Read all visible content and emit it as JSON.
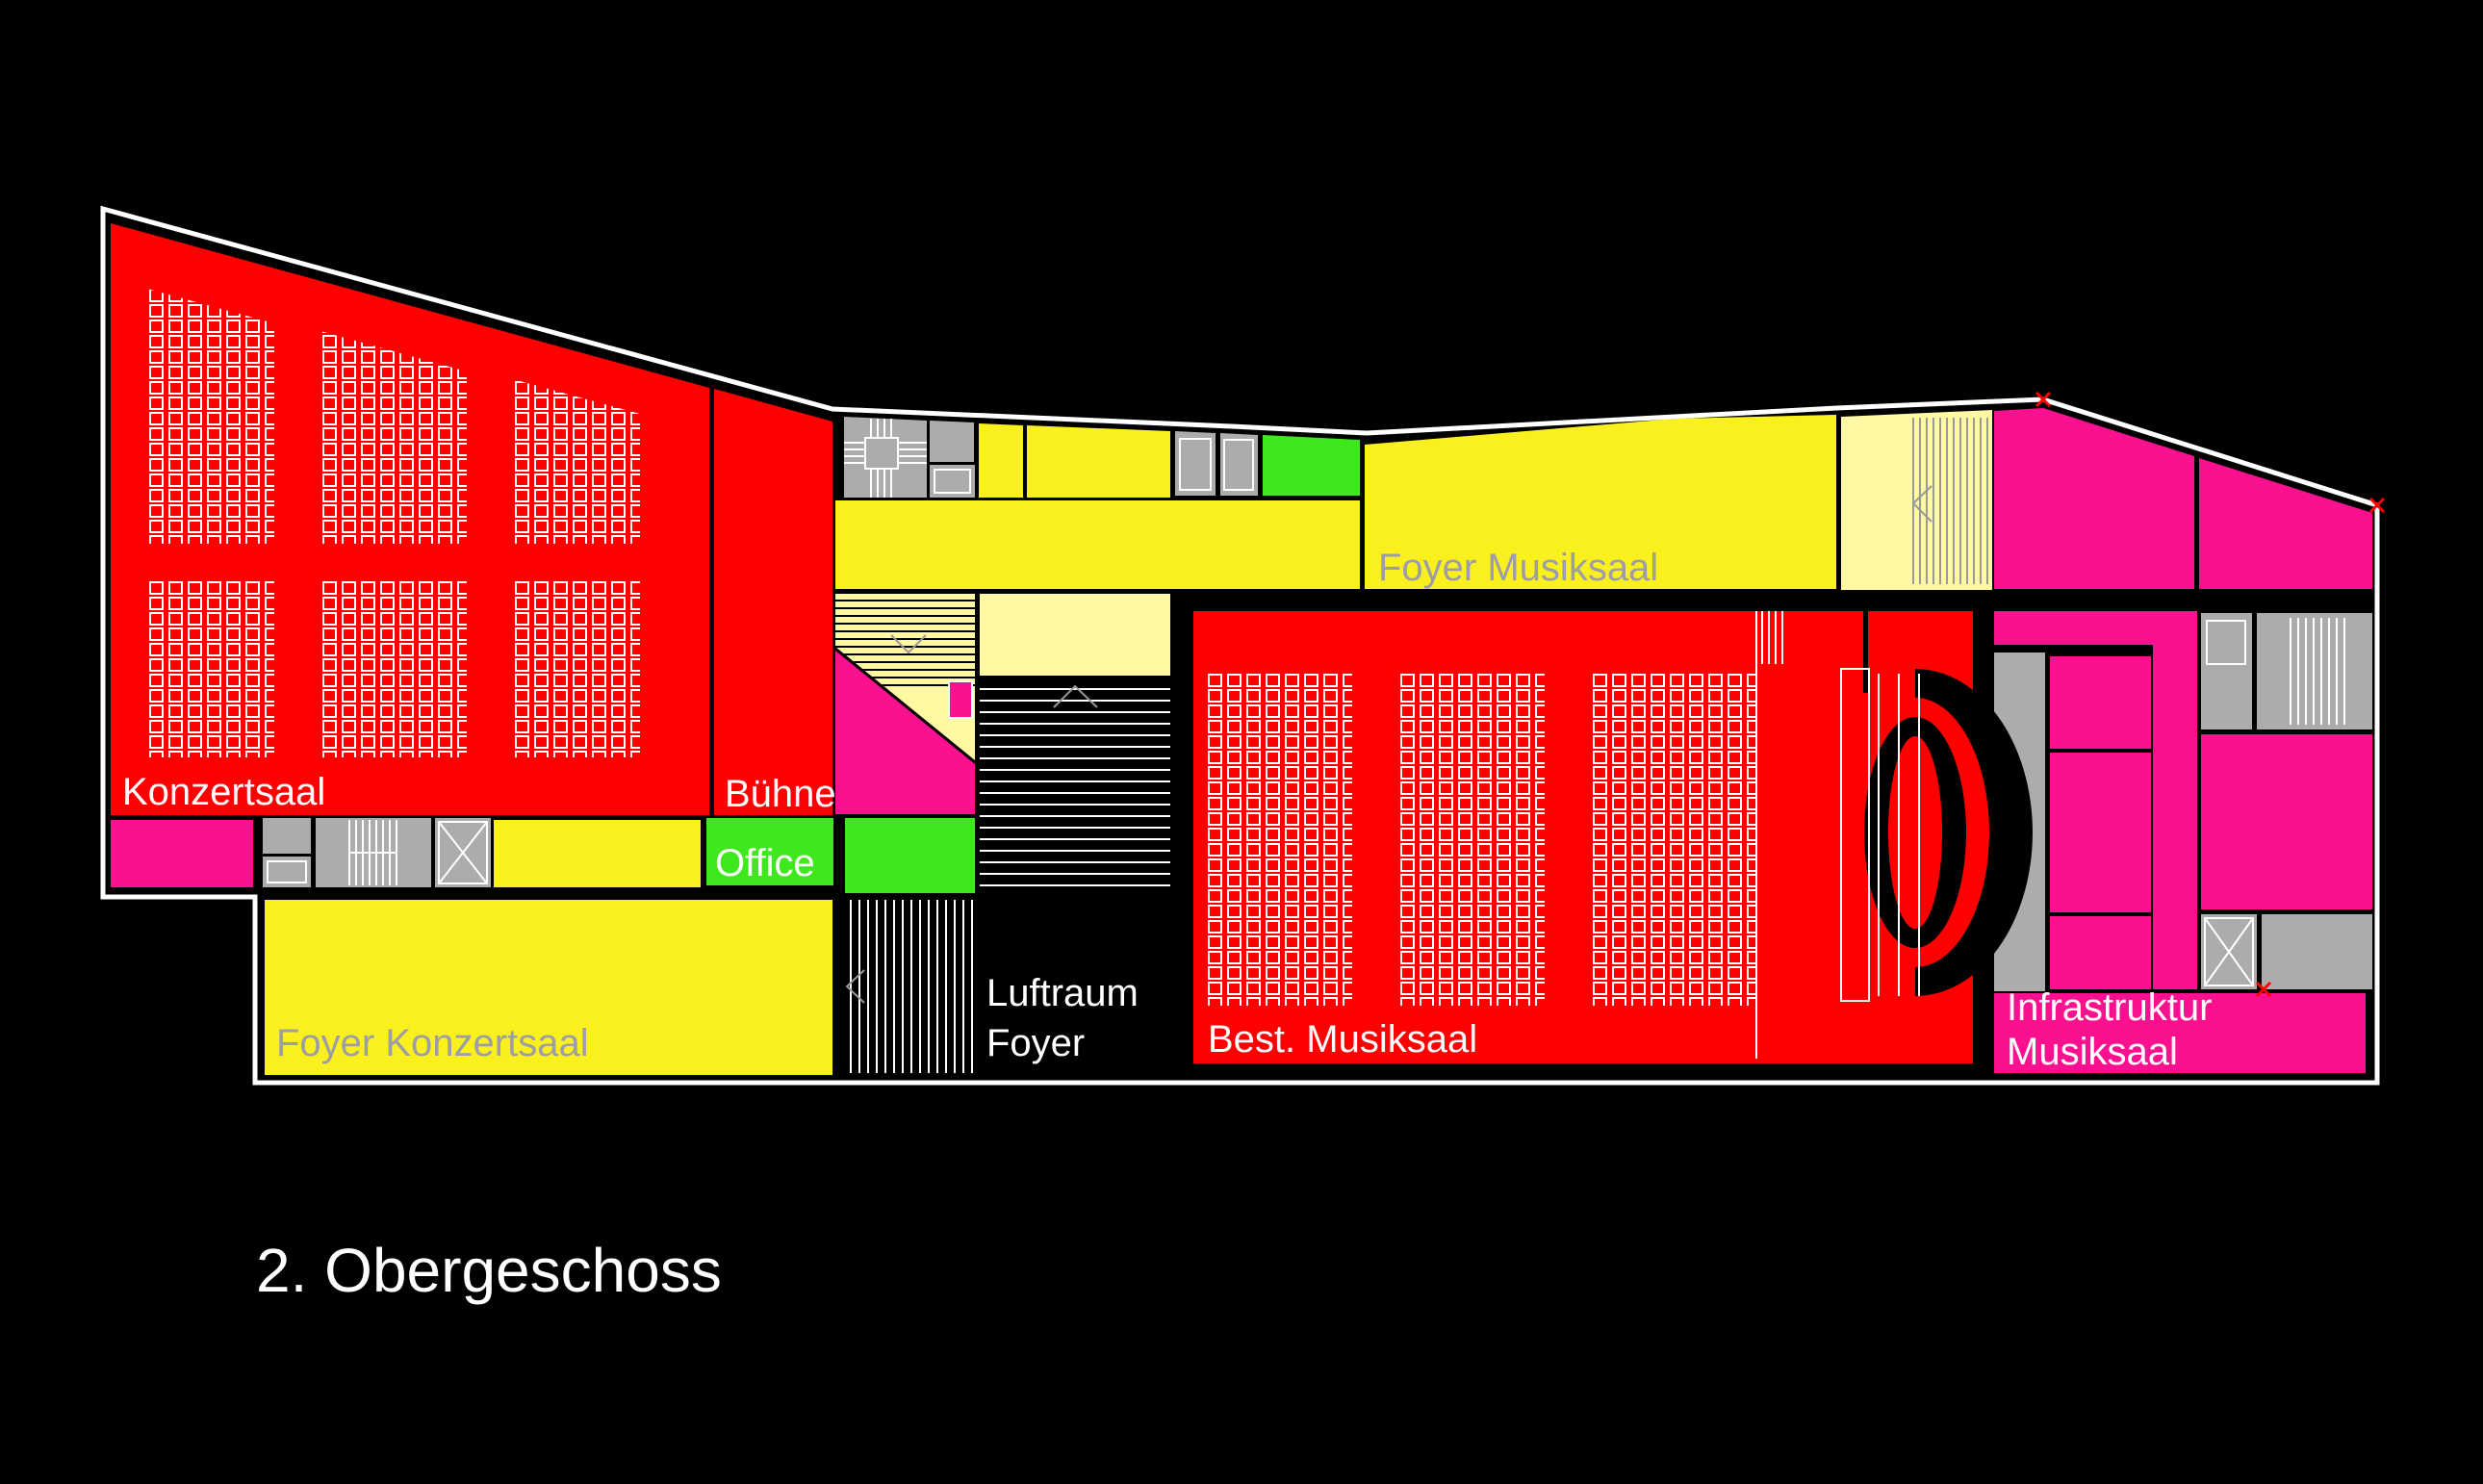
{
  "title": "2. Obergeschoss",
  "rooms": {
    "konzertsaal": "Konzertsaal",
    "buehne": "Bühne",
    "office": "Office",
    "foyer_konzertsaal": "Foyer Konzertsaal",
    "luftraum_line1": "Luftraum",
    "luftraum_line2": "Foyer",
    "best_musiksaal": "Best. Musiksaal",
    "foyer_musiksaal": "Foyer Musiksaal",
    "infrastruktur_line1": "Infrastruktur",
    "infrastruktur_line2": "Musiksaal"
  },
  "colors": {
    "red": "#FF0000",
    "magenta": "#FB1190",
    "yellow": "#FAF01E",
    "pale_yellow": "#FFF9A3",
    "green": "#3FE81C",
    "gray": "#ACACAC",
    "label_gray": "#9D9DA8",
    "chevron_gray": "#999999",
    "white": "#FFFFFF",
    "black": "#000000"
  }
}
